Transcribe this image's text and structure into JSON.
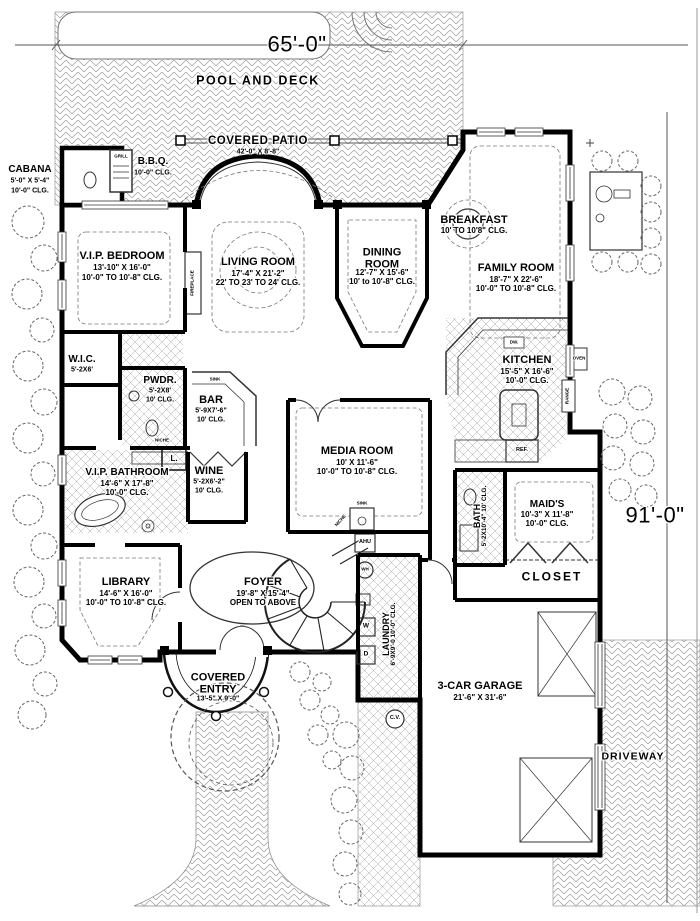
{
  "site": {
    "pool_label": "POOL AND DECK",
    "patio_name": "COVERED PATIO",
    "patio_dim": "42'-0\" X 8'-8\"",
    "driveway_label": "DRIVEWAY",
    "lot_width": "65'-0\"",
    "lot_depth": "91'-0\""
  },
  "rooms": {
    "cabana": {
      "name": "CABANA",
      "dim": "5'-0\" X 5'-4\"",
      "clg": "10'-0\" CLG."
    },
    "bbq": {
      "name": "B.B.Q.",
      "clg": "10'-0\" CLG."
    },
    "vip_bedroom": {
      "name": "V.I.P. BEDROOM",
      "dim": "13'-10\" X 16'-0\"",
      "clg": "10'-0\" TO 10'-8\" CLG."
    },
    "living_room": {
      "name": "LIVING ROOM",
      "dim": "17'-4\" X 21'-2\"",
      "clg": "22' TO 23' TO 24' CLG."
    },
    "dining_room": {
      "name": "DINING ROOM",
      "dim": "12'-7\" X 15'-6\"",
      "clg": "10' to 10'-8\" CLG."
    },
    "breakfast": {
      "name": "BREAKFAST",
      "clg": "10' TO 10'8\" CLG."
    },
    "family_room": {
      "name": "FAMILY ROOM",
      "dim": "18'-7\" X 22'-6\"",
      "clg": "10'-0\" TO 10'-8\" CLG."
    },
    "wic": {
      "name": "W.I.C.",
      "dim": "5'-2X6'"
    },
    "powder": {
      "name": "PWDR.",
      "dim": "5'-2X8'",
      "clg": "10' CLG."
    },
    "bar": {
      "name": "BAR",
      "dim": "5'-9X7'-6\"",
      "clg": "10' CLG."
    },
    "kitchen": {
      "name": "KITCHEN",
      "dim": "15'-5\" X 16'-6\"",
      "clg": "10'-0\" CLG."
    },
    "vip_bathroom": {
      "name": "V.I.P. BATHROOM",
      "dim": "14'-6\" X 17'-8\"",
      "clg": "10'-0\" CLG."
    },
    "wine": {
      "name": "WINE",
      "dim": "5'-2X6'-2\"",
      "clg": "10' CLG."
    },
    "media_room": {
      "name": "MEDIA ROOM",
      "dim": "10' X 11'-6\"",
      "clg": "10'-0\" TO 10'-8\" CLG."
    },
    "maids": {
      "name": "MAID'S",
      "dim": "10'-3\" X 11'-8\"",
      "clg": "10'-0\" CLG."
    },
    "bath": {
      "name": "BATH",
      "dim": "5'-2X10'-4\"",
      "clg": "10' CLG."
    },
    "closet": {
      "name": "CLOSET"
    },
    "library": {
      "name": "LIBRARY",
      "dim": "14'-6\" X 16'-0\"",
      "clg": "10'-0\" TO 10'-8\" CLG."
    },
    "foyer": {
      "name": "FOYER",
      "dim": "19'-8\" X 15'-4\"",
      "note": "OPEN TO ABOVE"
    },
    "covered_entry": {
      "name": "COVERED ENTRY",
      "dim": "13'-5\" X 9'-0\""
    },
    "laundry": {
      "name": "LAUNDRY",
      "dim": "6'-9X9'-0",
      "clg": "10'-0\" CLG."
    },
    "garage": {
      "name": "3-CAR GARAGE",
      "dim": "21'-6\" X 31'-6\""
    }
  },
  "fixtures": {
    "grill": "GRILL",
    "fireplace": "FIREPLACE",
    "bar_sink": "SINK",
    "media_sink": "SINK",
    "niche_powder": "NICHE",
    "niche_stair": "NICHE",
    "oven": "OVEN",
    "range": "RANGE",
    "fridge": "REF.",
    "dishwasher": "DW.",
    "ahu": "AHU",
    "water_heater": "WH",
    "washer": "W",
    "dryer": "D",
    "linen": "L.",
    "central_vac": "C.V."
  }
}
